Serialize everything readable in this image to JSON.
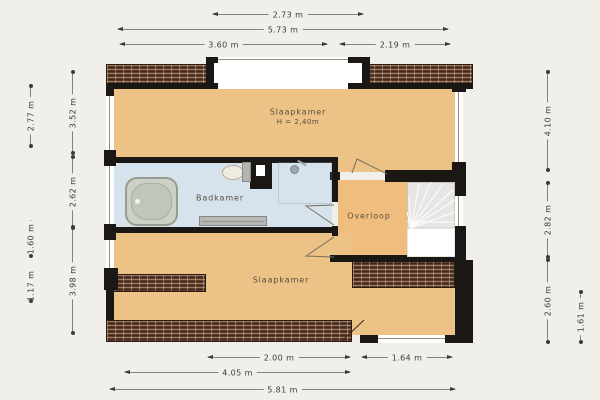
{
  "plan_type": "floorplan-upper-floor",
  "rooms": {
    "bedroom_top": {
      "label": "Slaapkamer",
      "height_note": "H = 2,40m"
    },
    "bathroom": {
      "label": "Badkamer"
    },
    "landing": {
      "label": "Overloop"
    },
    "bedroom_bottom": {
      "label": "Slaapkamer"
    }
  },
  "dimensions": {
    "top": {
      "window": "2.73 m",
      "total": "5.73 m",
      "left": "3.60 m",
      "right": "2.19 m"
    },
    "bottom": {
      "left": "2.00 m",
      "right": "1.64 m",
      "mid": "4.05 m",
      "total": "5.81 m"
    },
    "left": {
      "outer_top": "2.77 m",
      "outer_mid": "1.60 m",
      "outer_bottom": "1.17 m",
      "inner_top": "3.52 m",
      "inner_mid": "2.62 m",
      "inner_bottom": "3.98 m"
    },
    "right": {
      "inner_top": "4.10 m",
      "inner_mid": "2.82 m",
      "inner_bottom": "2.60 m",
      "outer_bottom": "1.61 m"
    }
  },
  "colors": {
    "background": "#f1efe9",
    "room_fill": "#ecc287",
    "landing_fill": "#efbe7e",
    "bathroom_fill": "#d6e3ec",
    "wall": "#1a1714",
    "roof_brick": "#5e3a28",
    "stairs": "#e7e6e4",
    "dimension_text": "#3a3a38"
  }
}
